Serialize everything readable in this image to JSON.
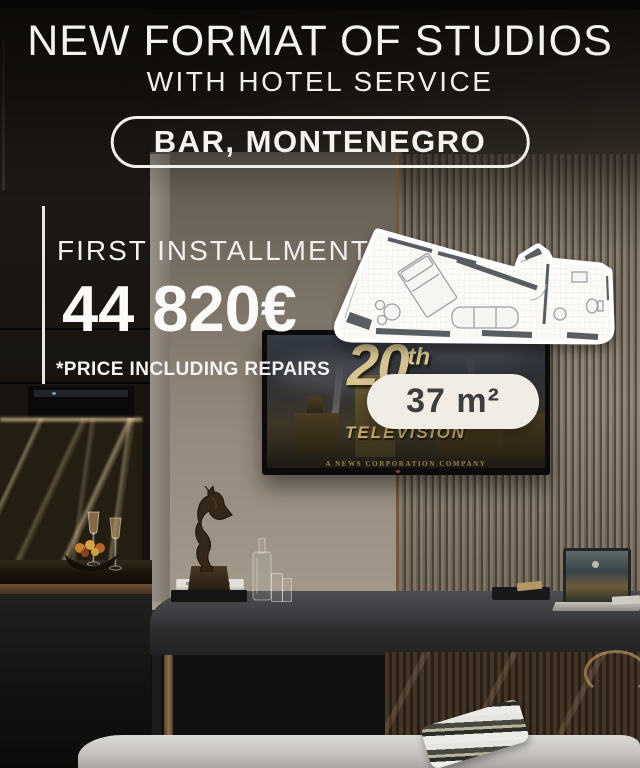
{
  "header": {
    "title": "NEW FORMAT OF STUDIOS",
    "subtitle": "WITH HOTEL SERVICE",
    "location_badge": "BAR, MONTENEGRO"
  },
  "offer": {
    "label": "FIRST INSTALLMENT",
    "price": "44 820€",
    "disclaimer": "*PRICE INCLUDING REPAIRS",
    "area_badge": "37 m²"
  },
  "tv_screen": {
    "logo_number": "20",
    "logo_suffix": "th",
    "logo_word": "TELEVISION",
    "caption": "A NEWS CORPORATION COMPANY"
  },
  "colors": {
    "cream": "#f1ede4",
    "white_text": "#f5f3ee",
    "badge_text": "#3d3e3e",
    "gold": "#d6c591"
  }
}
